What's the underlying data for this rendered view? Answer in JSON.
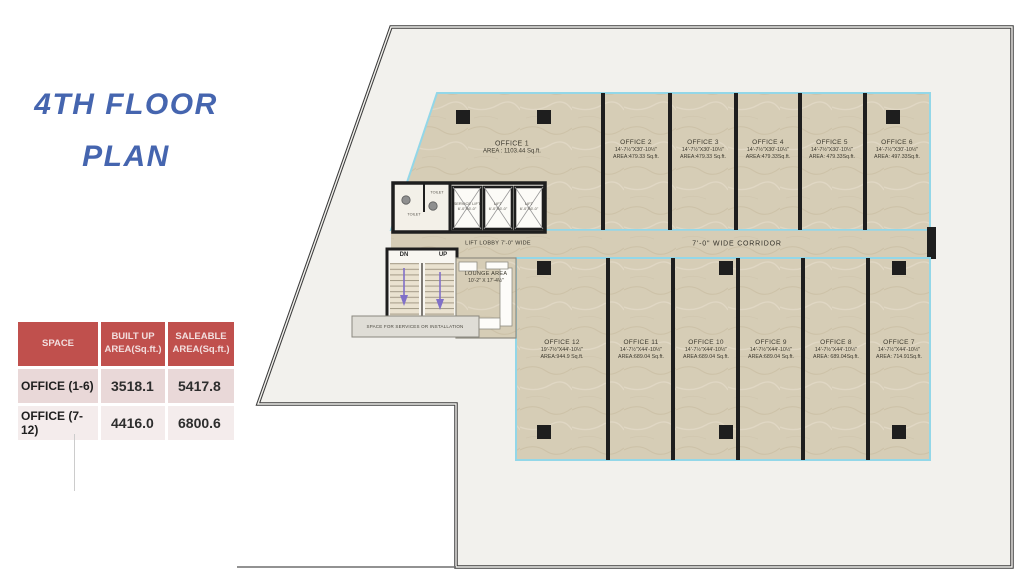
{
  "title": {
    "line1": "4TH FLOOR",
    "line2": "PLAN"
  },
  "summary_table": {
    "headers": [
      "SPACE",
      "BUILT UP AREA(Sq.ft.)",
      "SALEABLE AREA(Sq.ft.)"
    ],
    "rows": [
      {
        "space": "OFFICE (1-6)",
        "built_up": "3518.1",
        "saleable": "5417.8"
      },
      {
        "space": "OFFICE (7-12)",
        "built_up": "4416.0",
        "saleable": "6800.6"
      }
    ]
  },
  "plan": {
    "corridor_label": "7'-0\" WIDE CORRIDOR",
    "lift_lobby_label": "LIFT LOBBY 7'-0\" WIDE",
    "services_label": "SPACE FOR SERVICES OR INSTALLATION",
    "stair_dn": "DN",
    "stair_up": "UP",
    "toilet_label": "TOILET",
    "lounge": {
      "name": "LOUNGE AREA",
      "dim": "10'-2\" X 17'-4½\""
    },
    "lifts": [
      {
        "name": "SERVICE LIFT",
        "dim": "6'-0\"X6'-0\""
      },
      {
        "name": "LIFT",
        "dim": "6'-0\"X6'-0\""
      },
      {
        "name": "LIFT",
        "dim": "6'-0\"X6'-0\""
      }
    ],
    "offices_top": [
      {
        "name": "OFFICE 1",
        "dim": "",
        "area": "AREA : 1103.44 Sq.ft."
      },
      {
        "name": "OFFICE 2",
        "dim": "14'-7½\"X30'-10½\"",
        "area": "AREA:479.33 Sq.ft."
      },
      {
        "name": "OFFICE 3",
        "dim": "14'-7½\"X30'-10½\"",
        "area": "AREA:479.33 Sq.ft."
      },
      {
        "name": "OFFICE 4",
        "dim": "14'-7½\"X30'-10½\"",
        "area": "AREA:479.33Sq.ft."
      },
      {
        "name": "OFFICE 5",
        "dim": "14'-7½\"X30'-10½\"",
        "area": "AREA: 479.33Sq.ft."
      },
      {
        "name": "OFFICE 6",
        "dim": "14'-7½\"X30'-10½\"",
        "area": "AREA: 497.33Sq.ft."
      }
    ],
    "offices_bottom": [
      {
        "name": "OFFICE 12",
        "dim": "19'-7½\"X44'-10½\"",
        "area": "AREA:944.9 Sq.ft."
      },
      {
        "name": "OFFICE 11",
        "dim": "14'-7½\"X44'-10½\"",
        "area": "AREA:689.04 Sq.ft."
      },
      {
        "name": "OFFICE 10",
        "dim": "14'-7½\"X44'-10½\"",
        "area": "AREA:689.04 Sq.ft."
      },
      {
        "name": "OFFICE 9",
        "dim": "14'-7½\"X44'-10½\"",
        "area": "AREA:689.04 Sq.ft."
      },
      {
        "name": "OFFICE 8",
        "dim": "14'-7½\"X44'-10½\"",
        "area": "AREA: 689.04Sq.ft."
      },
      {
        "name": "OFFICE 7",
        "dim": "14'-7½\"X44'-10½\"",
        "area": "AREA: 714.91Sq.ft."
      }
    ]
  },
  "colors": {
    "title_blue": "#4565af",
    "table_header_red": "#c0504d",
    "office_fill_beige": "#d6cdb6",
    "outline_cyan": "#93d7e8",
    "wall_black": "#1e1e1e"
  }
}
